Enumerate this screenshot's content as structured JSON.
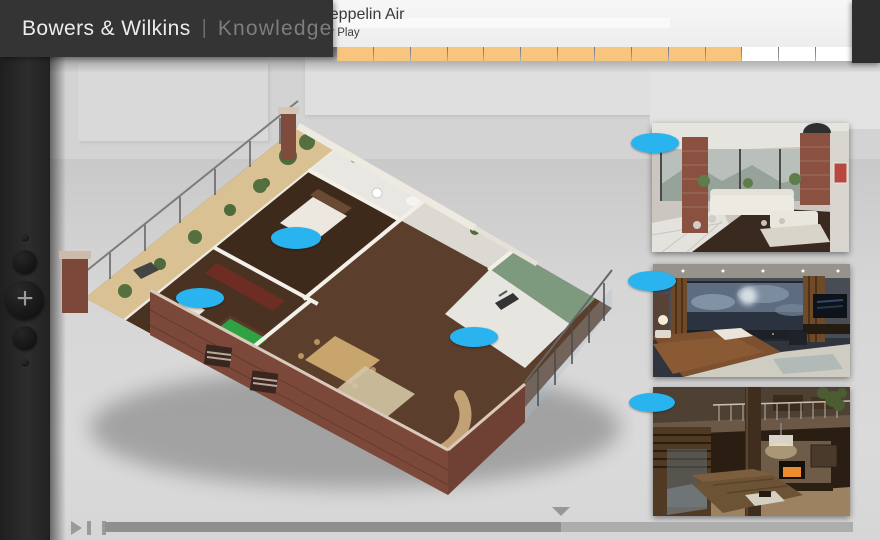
{
  "brand": {
    "name": "Bowers & Wilkins",
    "separator": "|",
    "section": "Knowledge"
  },
  "header": {
    "title": "Zeppelin Air",
    "subtitle": "Air Play"
  },
  "progress_bar": {
    "segments_total": 14,
    "segments_filled": 11,
    "filled_color": "#f8c57e",
    "empty_color": "#ffffff"
  },
  "side_controls": {
    "plus_label": "+"
  },
  "player": {
    "progress_percent": 61,
    "playhead_percent": 61
  },
  "markers": {
    "color": "#29b4f0",
    "items": [
      {
        "id": "floorplan-bedroom"
      },
      {
        "id": "floorplan-kitchen-bar"
      },
      {
        "id": "floorplan-living-room"
      },
      {
        "id": "photo-loft-living-room"
      },
      {
        "id": "photo-bedroom-evening"
      },
      {
        "id": "photo-lounge-fireplace"
      }
    ]
  },
  "photos": [
    {
      "id": "loft-living-room"
    },
    {
      "id": "bedroom-evening"
    },
    {
      "id": "lounge-fireplace"
    }
  ]
}
